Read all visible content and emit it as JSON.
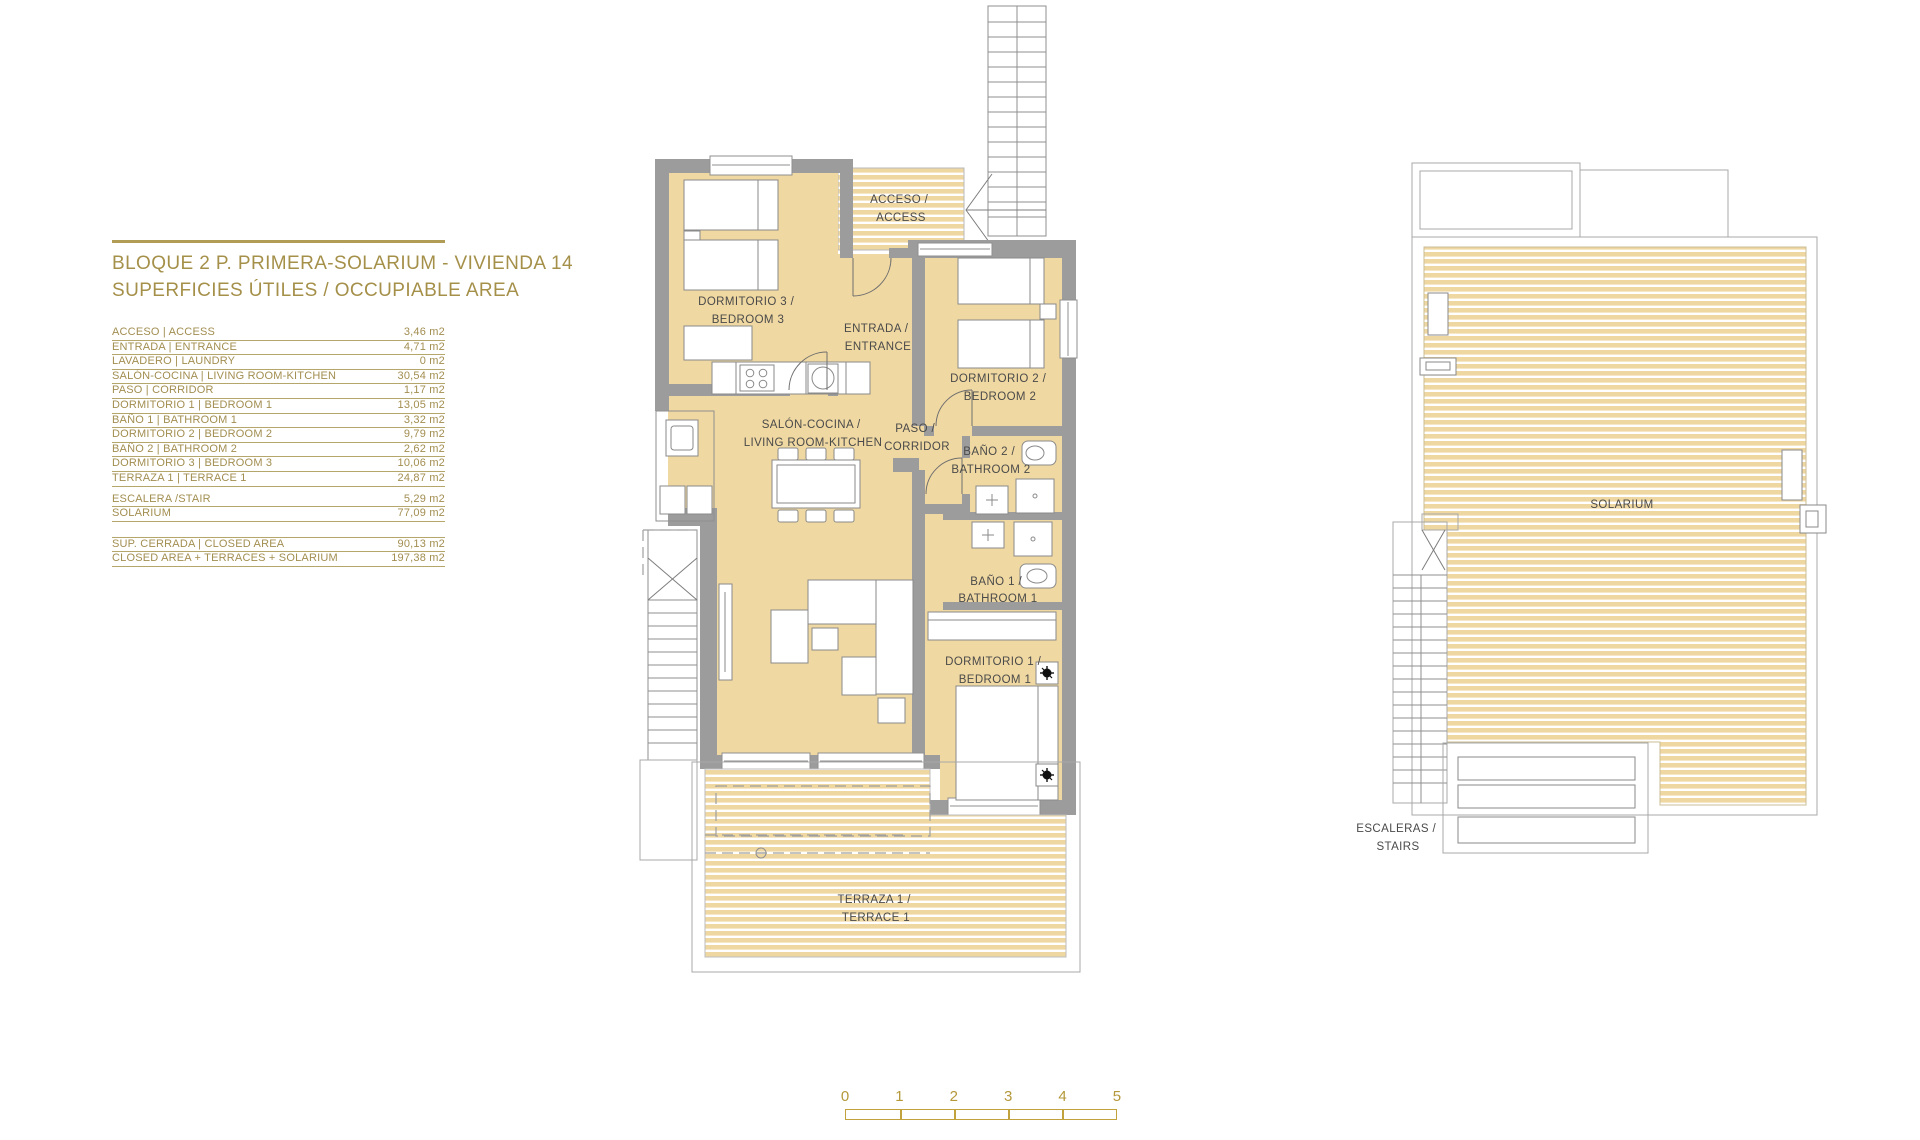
{
  "title_block": {
    "line1": "BLOQUE 2 P. PRIMERA-SOLARIUM - VIVIENDA 14",
    "line2": "SUPERFICIES ÚTILES / OCCUPIABLE AREA"
  },
  "area_table": {
    "rows": [
      {
        "label": "ACCESO | ACCESS",
        "value": "3,46 m2"
      },
      {
        "label": "ENTRADA | ENTRANCE",
        "value": "4,71 m2"
      },
      {
        "label": "LAVADERO | LAUNDRY",
        "value": "0 m2"
      },
      {
        "label": "SALÓN-COCINA | LIVING ROOM-KITCHEN",
        "value": "30,54 m2"
      },
      {
        "label": "PASO | CORRIDOR",
        "value": "1,17 m2"
      },
      {
        "label": "DORMITORIO 1 | BEDROOM 1",
        "value": "13,05 m2"
      },
      {
        "label": "BAÑO 1 | BATHROOM 1",
        "value": "3,32 m2"
      },
      {
        "label": "DORMITORIO 2 | BEDROOM 2",
        "value": "9,79 m2"
      },
      {
        "label": "BAÑO 2 | BATHROOM 2",
        "value": "2,62 m2"
      },
      {
        "label": "DORMITORIO 3 | BEDROOM 3",
        "value": "10,06 m2"
      },
      {
        "label": "TERRAZA 1 | TERRACE 1",
        "value": "24,87 m2"
      },
      {
        "label": "ESCALERA /STAIR",
        "value": "5,29 m2",
        "gap_before": true
      },
      {
        "label": "SOLARIUM",
        "value": "77,09 m2"
      }
    ],
    "summary_rows": [
      {
        "label": "SUP. CERRADA | CLOSED AREA",
        "value": "90,13 m2"
      },
      {
        "label": "CLOSED AREA + TERRACES + SOLARIUM",
        "value": "197,38 m2"
      }
    ]
  },
  "floor_plan": {
    "rooms": {
      "acceso": {
        "l1": "ACCESO /",
        "l2": "ACCESS"
      },
      "entrada": {
        "l1": "ENTRADA /",
        "l2": "ENTRANCE"
      },
      "dormitorio3": {
        "l1": "DORMITORIO 3 /",
        "l2": "BEDROOM 3"
      },
      "dormitorio2": {
        "l1": "DORMITORIO 2 /",
        "l2": "BEDROOM 2"
      },
      "dormitorio1": {
        "l1": "DORMITORIO 1 /",
        "l2": "BEDROOM 1"
      },
      "salon": {
        "l1": "SALÓN-COCINA /",
        "l2": "LIVING ROOM-KITCHEN"
      },
      "paso": {
        "l1": "PASO /",
        "l2": "CORRIDOR"
      },
      "bano2": {
        "l1": "BAÑO 2 /",
        "l2": "BATHROOM 2"
      },
      "bano1": {
        "l1": "BAÑO 1 /",
        "l2": "BATHROOM 1"
      },
      "terraza": {
        "l1": "TERRAZA 1 /",
        "l2": "TERRACE 1"
      }
    }
  },
  "solarium_plan": {
    "solarium_label": "SOLARIUM",
    "stairs": {
      "l1": "ESCALERAS /",
      "l2": "STAIRS"
    }
  },
  "scale_bar": {
    "ticks": [
      {
        "n": "0"
      },
      {
        "n": "1"
      },
      {
        "n": "2"
      },
      {
        "n": "3"
      },
      {
        "n": "4"
      },
      {
        "n": "5"
      }
    ]
  },
  "colors": {
    "accent_gold": "#a5904a",
    "table_line_gold": "#b5a66c",
    "scale_gold": "#c2a23c",
    "floor_tan": "#f0d8a2",
    "wall_gray": "#9c9c9c",
    "label_gray": "#4a4a4a"
  }
}
